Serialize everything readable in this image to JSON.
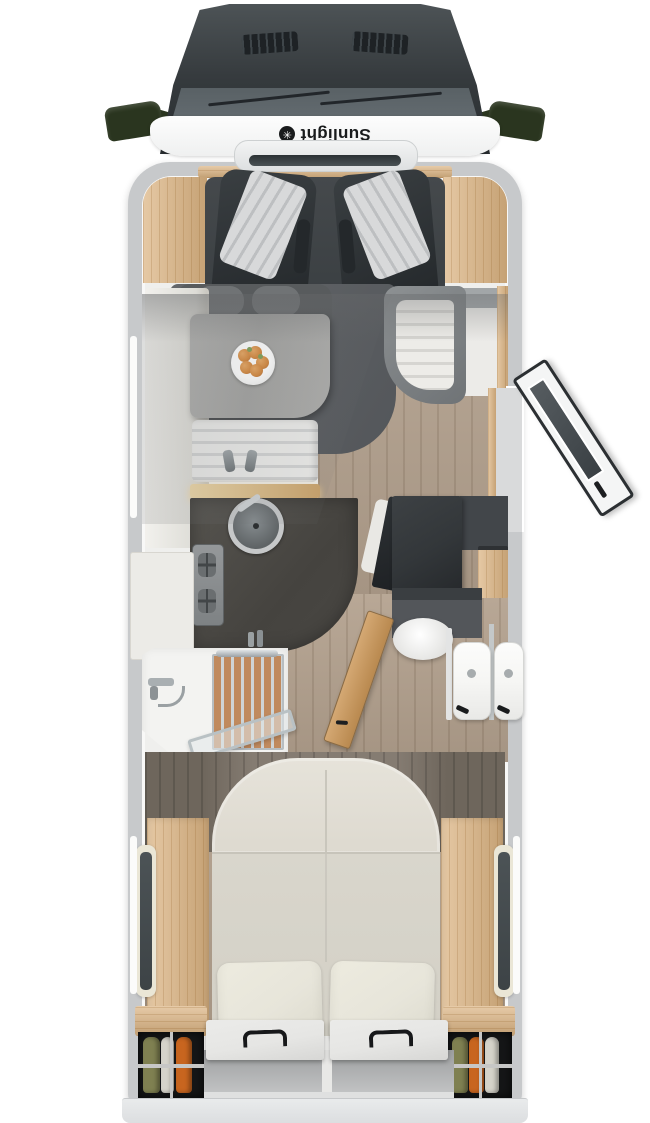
{
  "window": {
    "width": 650,
    "height": 1123,
    "background": "#ffffff",
    "view": "top-down cutaway floor plan of a motorhome"
  },
  "vehicle": {
    "kind": "Sunlight motorhome floor plan render",
    "brand_logo": {
      "text": "Sunlight",
      "icon_glyph": "✳",
      "icon": "sun-asterisk-icon",
      "orientation": "rotated-180"
    }
  },
  "palette": {
    "hood": "#363b3e",
    "glass": "#636b70",
    "mirror": "#2a351f",
    "body_wall": "#c7c9cb",
    "interior": "#efefed",
    "oak": "#dcb482",
    "floor_wood": "#b3a18e",
    "cab_floor": "#3a3f42",
    "seat_stripe": "#d8d9da",
    "bench_gray": "#585b5d",
    "table": "#a3a3a1",
    "counter": "#45433f",
    "sink": "#5f6466",
    "black_unit": "#33373a",
    "vanity": "#53565a",
    "fixture_white": "#f6f6f4",
    "teak": "#c08a5e",
    "glass_door_frame": "#b9c1c4",
    "headboard": "#857c72",
    "duvet": "#d9d6cc",
    "pillow": "#e7e5da",
    "garage": "#151617",
    "hatch": "#e6e6e4",
    "handle": "#17181a",
    "bumper": "#e9ebec",
    "fruit": "#d5893f",
    "leaf": "#7fa05a",
    "clothes": [
      "#7f8051",
      "#d5d3ca",
      "#c8651f"
    ]
  },
  "zones": {
    "cab": {
      "items": [
        "driver-seat",
        "passenger-seat",
        "side-mirror-left",
        "side-mirror-right",
        "hood-vents",
        "windshield-wipers",
        "front-skylight"
      ]
    },
    "dinette": {
      "items": [
        "front-bench",
        "dinette-table",
        "fruit-plate",
        "side-bench-right",
        "sideboard",
        "tall-cabinet-left"
      ]
    },
    "kitchen": {
      "items": [
        "kitchen-bench",
        "lit-spice-shelf",
        "dark-counter",
        "round-sink",
        "sink-faucet",
        "gas-hob",
        "fridge"
      ]
    },
    "entrance": {
      "items": [
        "entry-door-open",
        "door-window",
        "door-handle",
        "doorway-step"
      ]
    },
    "midship": {
      "items": [
        "black-tv-wardrobe",
        "wardrobe-door-open",
        "oak-side-cabinet"
      ]
    },
    "bathroom": {
      "items": [
        "vanity",
        "washbasin",
        "toilet",
        "toilet-mirror-reflection",
        "partition-wall",
        "mirror-wall",
        "bathroom-door-open"
      ]
    },
    "shower": {
      "items": [
        "shower-tray",
        "teak-grate",
        "towel-bar",
        "shower-faucet",
        "toiletry-bottles",
        "glass-door-open"
      ]
    },
    "bedroom": {
      "items": [
        "island-bed",
        "mattress-seam",
        "pillow-left",
        "pillow-right",
        "bedside-bench-left",
        "bedside-bench-right",
        "window-left",
        "window-right",
        "headboard-panel"
      ]
    },
    "rear_garage": {
      "items": [
        "wardrobe-left-with-clothes",
        "wardrobe-right-with-clothes",
        "storage-hatch-left",
        "storage-hatch-right",
        "hatch-handles",
        "open-shelf",
        "rear-bumper"
      ]
    }
  }
}
